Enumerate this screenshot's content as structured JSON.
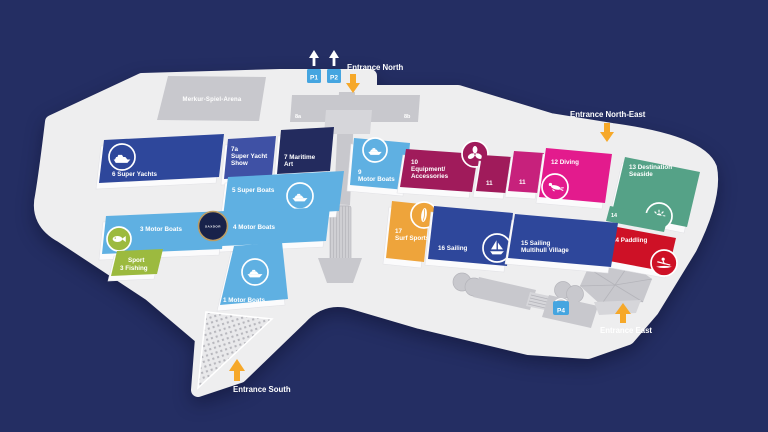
{
  "colors": {
    "background": "#242e63",
    "map_surface": "#eeeeef",
    "building_gray": "#c8c8cd",
    "accent_arrow_orange": "#f6a829",
    "parking_blue": "#45a5e0",
    "hall_dark_blue": "#2e479b",
    "hall_light_blue": "#5fb0e2",
    "hall_indigo": "#3f51a5",
    "hall_navy": "#232b5e",
    "hall_berry": "#a01b5b",
    "hall_magenta": "#c7217c",
    "hall_pink": "#e31b8d",
    "hall_seafoam_green": "#55a287",
    "hall_red": "#ce1126",
    "hall_orange": "#eea43b",
    "hall_lime_green": "#9cba3f",
    "badge_navy": "#18224a",
    "badge_gold": "#bb9c63"
  },
  "arena": {
    "label": "Merkur-Spiel-Arena"
  },
  "buildings": {
    "b8a": "8a",
    "b8b": "8b"
  },
  "entrances": {
    "north": "Entrance North",
    "north_east": "Entrance North-East",
    "east": "Entrance East",
    "south": "Entrance South"
  },
  "parking": {
    "p1": "P1",
    "p2": "P2",
    "p4": "P4"
  },
  "badge": {
    "label": "SAXDOR"
  },
  "halls": {
    "h1": {
      "label": "1 Motor Boats",
      "icon": "motorboat-icon"
    },
    "h3": {
      "label": "3 Motor Boats",
      "icon": "fish-icon"
    },
    "fishing": {
      "line1": "Sport",
      "line2": "3 Fishing"
    },
    "h4": {
      "label": "4 Motor Boats"
    },
    "h5": {
      "label": "5 Super Boats",
      "icon": "speedboat-icon"
    },
    "h6": {
      "label": "6 Super Yachts",
      "icon": "yacht-icon"
    },
    "h7a": {
      "line1": "7a",
      "line2": "Super Yacht",
      "line3": "Show"
    },
    "h7": {
      "line1": "7 Maritime",
      "line2": "Art"
    },
    "h9": {
      "line1": "9",
      "line2": "Motor Boats",
      "icon": "motorboat-icon"
    },
    "h10": {
      "line1": "10",
      "line2": "Equipment/",
      "line3": "Accessories",
      "icon": "propeller-icon"
    },
    "h11a": {
      "label": "11"
    },
    "h11b": {
      "label": "11"
    },
    "h12": {
      "label": "12 Diving",
      "icon": "diver-icon"
    },
    "h13": {
      "line1": "13 Destination",
      "line2": "Seaside",
      "icon": "sun-icon"
    },
    "h14a": {
      "label": "14"
    },
    "h14": {
      "label": "14 Paddling",
      "icon": "kayak-icon"
    },
    "h15": {
      "line1": "15 Sailing",
      "line2": "Multihull Village"
    },
    "h16": {
      "label": "16 Sailing",
      "icon": "sailboat-icon"
    },
    "h17": {
      "line1": "17",
      "line2": "Surf Sports",
      "icon": "surfboard-icon"
    }
  }
}
